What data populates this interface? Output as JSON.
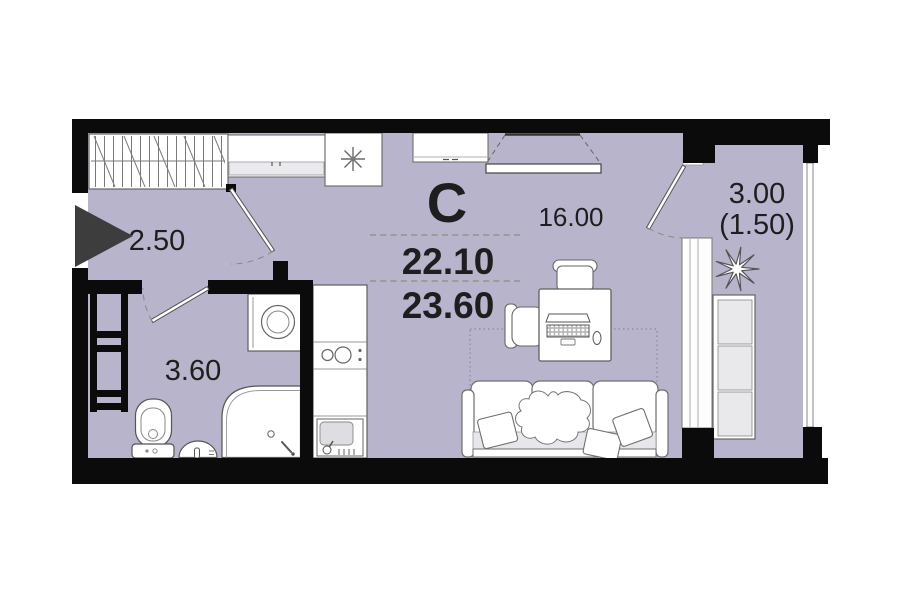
{
  "meta": {
    "type": "apartment-floor-plan",
    "style": "studio"
  },
  "labels": {
    "plan_letter": "С",
    "living_room_area": "16.00",
    "hallway_area": "2.50",
    "bathroom_area": "3.60",
    "balcony_area": "3.00",
    "balcony_area_coefficient": "(1.50)",
    "living_area_total": "22.10",
    "total_area": "23.60"
  },
  "colors": {
    "floor": "#b7b4cb",
    "walls": "#0b0b0b",
    "entry_arrow": "#3d3d3d",
    "furniture_fill": "#ffffff",
    "furniture_outline": "#666666",
    "accent_gray": "#e9e9ec"
  },
  "icons": {
    "fridge_icon": "snowflake-asterisk",
    "plant_icon": "starburst",
    "entry_icon": "right-pointing-triangle",
    "wardrobe_icon": "hatched-rect"
  }
}
